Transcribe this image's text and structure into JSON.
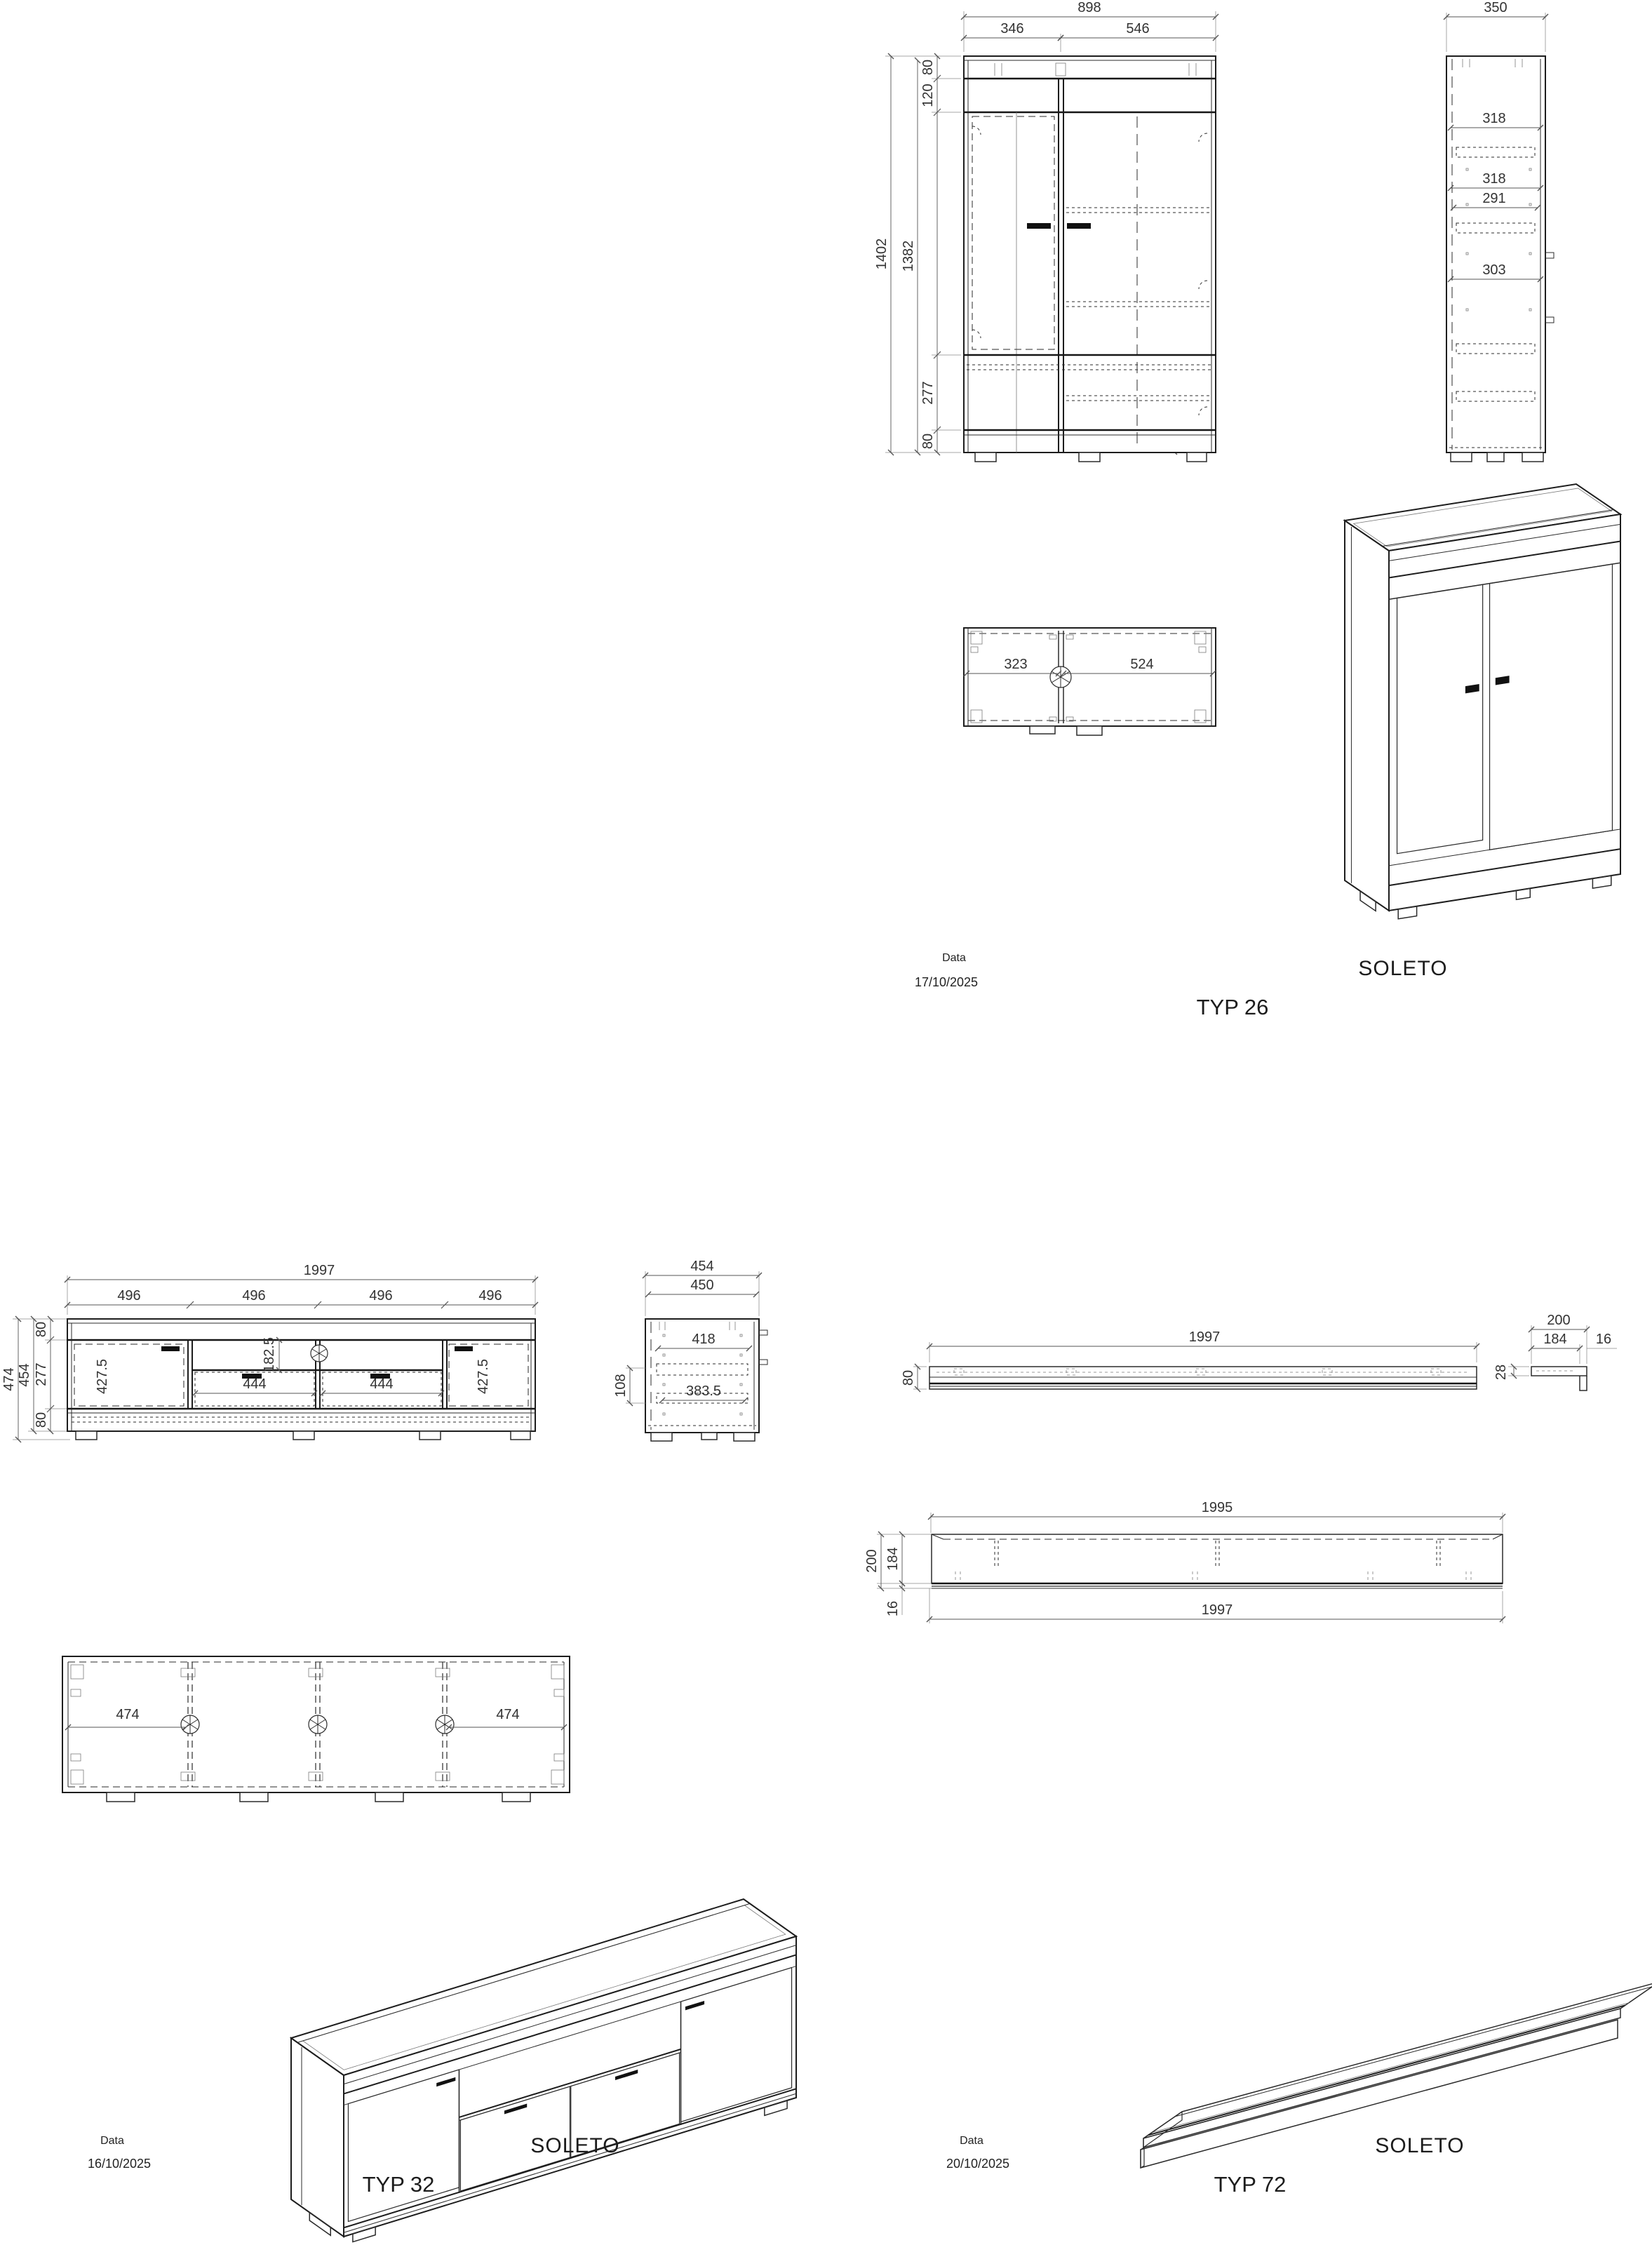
{
  "typ26": {
    "meta": {
      "date_label": "Data",
      "date": "17/10/2025",
      "brand": "SOLETO",
      "title": "TYP 26"
    },
    "front": {
      "w898": "898",
      "w346": "346",
      "w546": "546",
      "h1402": "1402",
      "h1382": "1382",
      "t80": "80",
      "t120": "120",
      "v599": "599",
      "v419": "419",
      "v320": "320",
      "v277": "277",
      "b80": "80",
      "w324": "324",
      "v339": "339",
      "w525a": "525",
      "w525b": "525",
      "v336a": "336",
      "w525c": "525",
      "v336b": "336",
      "w525d": "525",
      "v291": "291"
    },
    "side": {
      "w350": "350",
      "d318a": "318",
      "d318b": "318",
      "d291": "291",
      "d303": "303"
    },
    "top": {
      "w323": "323",
      "w524": "524"
    }
  },
  "typ32": {
    "meta": {
      "date_label": "Data",
      "date": "16/10/2025",
      "brand": "SOLETO",
      "title": "TYP 32"
    },
    "front": {
      "w1997": "1997",
      "c1": "496",
      "c2": "496",
      "c3": "496",
      "c4": "496",
      "h474": "474",
      "h454": "454",
      "t80": "80",
      "m277": "277",
      "b80": "80",
      "doorL": "427.5",
      "doorR": "427.5",
      "niche": "182.5",
      "dr1": "444",
      "dr2": "444"
    },
    "side": {
      "w454": "454",
      "w450": "450",
      "d418": "418",
      "d3835": "383.5",
      "h108": "108"
    },
    "bottom": {
      "dL": "474",
      "dR": "474"
    }
  },
  "typ72": {
    "meta": {
      "date_label": "Data",
      "date": "20/10/2025",
      "brand": "SOLETO",
      "title": "TYP 72"
    },
    "front": {
      "w1997": "1997",
      "h80": "80"
    },
    "end": {
      "d200": "200",
      "d184": "184",
      "t16": "16",
      "t28": "28"
    },
    "top": {
      "wi": "1995",
      "wo": "1997",
      "d200": "200",
      "d184": "184",
      "t16": "16"
    }
  }
}
